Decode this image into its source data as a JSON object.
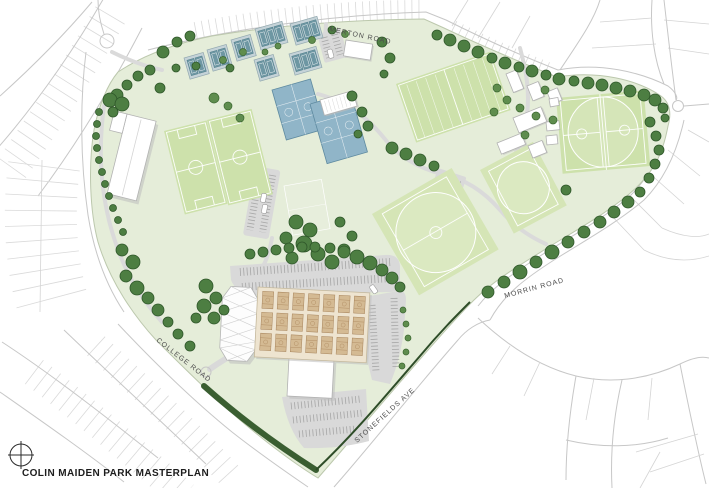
{
  "page_title": "COLIN MAIDEN PARK MASTERPLAN",
  "road_labels": {
    "merton": "MERTON ROAD",
    "morrin": "MORRIN ROAD",
    "college": "COLLEGE ROAD",
    "stonefields": "STONEFIELDS AVE"
  },
  "icons": {
    "north_arrow": "compass-crosshair-icon"
  },
  "map_colors": {
    "park_green": "#e5edd9",
    "sports_field_green": "#cde1ab",
    "tree_green": "#4d7e42",
    "hardcourt_blue": "#90b5c8",
    "tennis_court_teal": "#6e97a3",
    "indoor_court_tan": "#d4ba93",
    "parking_grey": "#d9d9d9",
    "building_white": "#ffffff",
    "road_line_grey": "#c7c7c7",
    "hedge_dark_green": "#3a5e31",
    "label_grey": "#4e4e4e",
    "title_black": "#1d1d1d"
  }
}
